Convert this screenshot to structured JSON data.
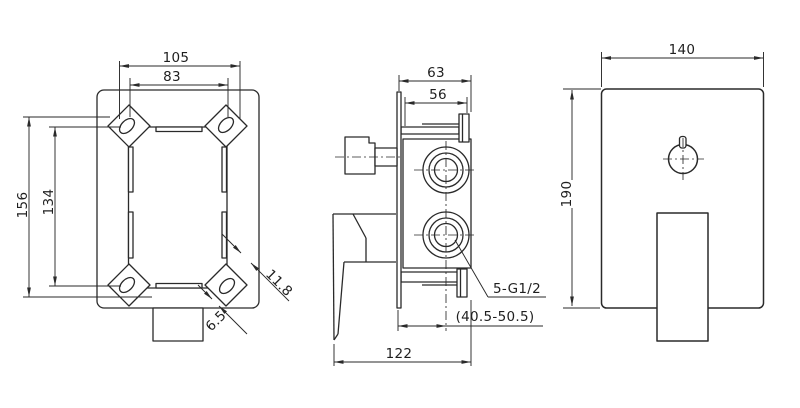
{
  "drawing": {
    "back_view": {
      "dims": {
        "width_outer": "105",
        "width_inner": "83",
        "height_outer": "156",
        "height_inner": "134",
        "slot_width": "6.5",
        "tab_width": "11.8"
      }
    },
    "side_view": {
      "dims": {
        "depth_total": "63",
        "depth_body": "56",
        "length_total": "122",
        "wall_depth_range": "(40.5-50.5)",
        "thread_label": "5-G1/2"
      }
    },
    "front_view": {
      "dims": {
        "plate_width": "140",
        "plate_height": "190"
      }
    }
  },
  "colors": {
    "line": "#2a2a2a",
    "background": "#ffffff"
  }
}
